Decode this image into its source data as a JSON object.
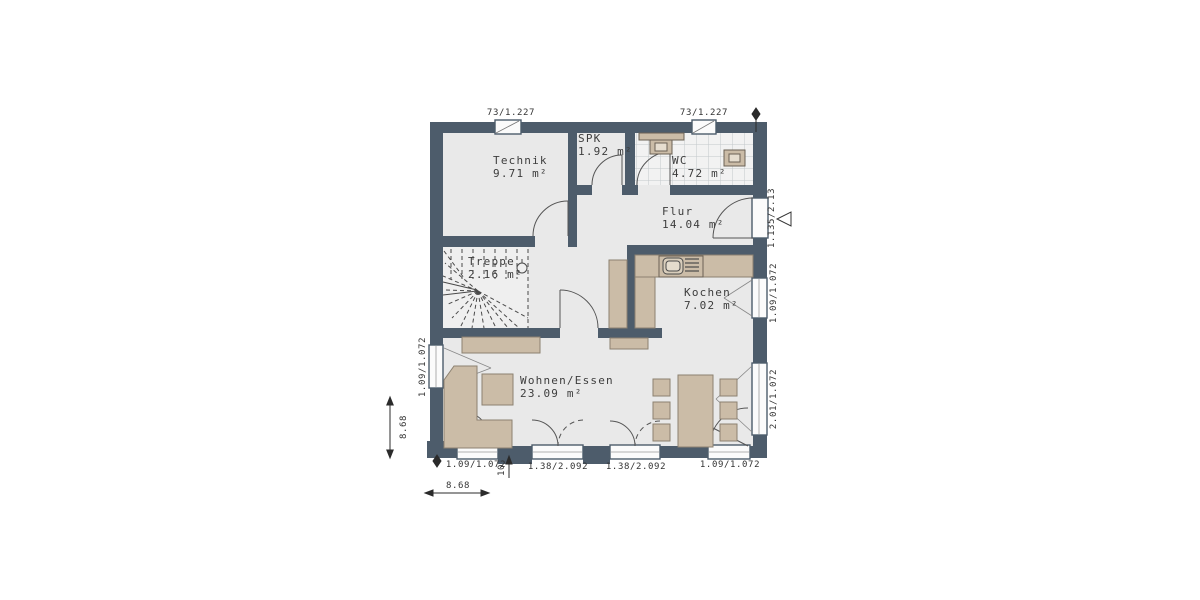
{
  "rooms": [
    {
      "id": "technik",
      "name": "Technik",
      "area": "9.71 m²"
    },
    {
      "id": "spk",
      "name": "SPK",
      "area": "1.92 m²"
    },
    {
      "id": "wc",
      "name": "WC",
      "area": "4.72 m²"
    },
    {
      "id": "flur",
      "name": "Flur",
      "area": "14.04 m²"
    },
    {
      "id": "treppe",
      "name": "Treppe",
      "area": "2.16 m²"
    },
    {
      "id": "kochen",
      "name": "Kochen",
      "area": "7.02 m²"
    },
    {
      "id": "wohnen",
      "name": "Wohnen/Essen",
      "area": "23.09 m²"
    }
  ],
  "dimensions": {
    "top_window_1": "73/1.227",
    "top_window_2": "73/1.227",
    "entrance_door": "1.135/2.13",
    "right_kitchen_window": "1.09/1.072",
    "right_living_window": "2.01/1.072",
    "left_window": "1.09/1.072",
    "left_total": "8.68",
    "bottom_window_1": "1.09/1.072",
    "bottom_door_1": "1.38/2.092",
    "bottom_door_2": "1.38/2.092",
    "bottom_window_2": "1.09/1.072",
    "bottom_total": "8.68",
    "threshold": "10"
  },
  "colors": {
    "wall": "#4d5c6b",
    "floor": "#e9e9e9",
    "tile_floor": "#f2f2f2",
    "furniture": "#cbbca7",
    "line": "#4a4a4a"
  }
}
